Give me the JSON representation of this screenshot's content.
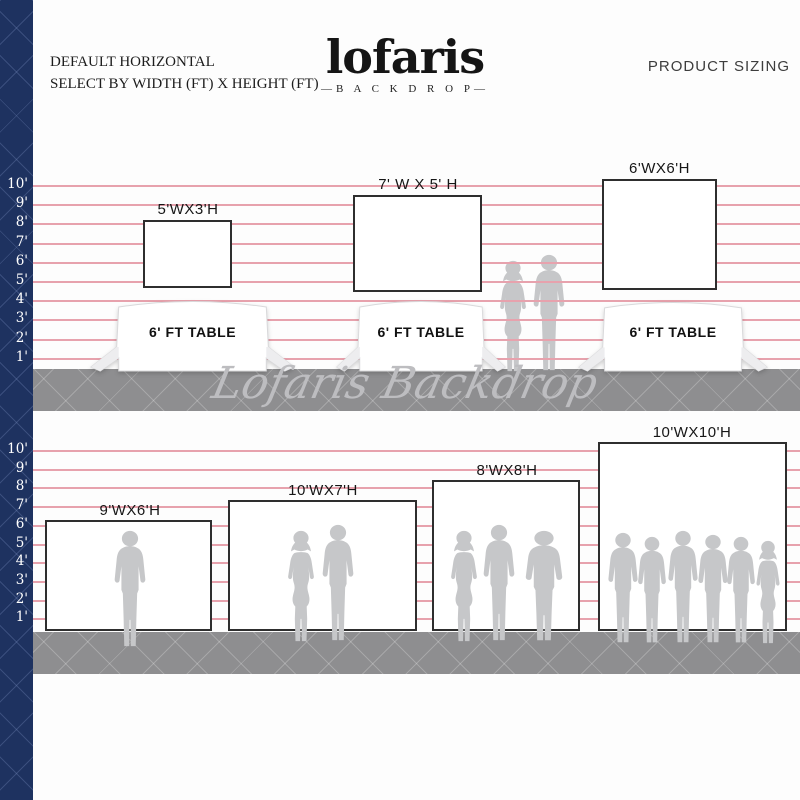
{
  "header": {
    "left_title_line1": "DEFAULT HORIZONTAL",
    "left_title_line2": "SELECT BY WIDTH (FT) X HEIGHT (FT)",
    "logo_name": "lofaris",
    "logo_sub": "—B A C K D R O P—",
    "right_title": "PRODUCT SIZING"
  },
  "watermark": "Lofaris Backdrop",
  "ruler": {
    "labels": [
      "10'",
      "9'",
      "8'",
      "7'",
      "6'",
      "5'",
      "4'",
      "3'",
      "2'",
      "1'"
    ],
    "unit": "ft"
  },
  "rows": [
    {
      "name": "table-backdrops",
      "items": [
        {
          "size_label": "5'WX3'H",
          "table_label": "6' FT TABLE"
        },
        {
          "size_label": "7' W X 5' H",
          "table_label": "6' FT TABLE"
        },
        {
          "size_label": "6'WX6'H",
          "table_label": "6' FT TABLE"
        }
      ]
    },
    {
      "name": "people-backdrops",
      "items": [
        {
          "size_label": "9'WX6'H",
          "people_count": 1
        },
        {
          "size_label": "10'WX7'H",
          "people_count": 2
        },
        {
          "size_label": "8'WX8'H",
          "people_count": 3
        },
        {
          "size_label": "10'WX10'H",
          "people_count": 6
        }
      ]
    }
  ],
  "colors": {
    "navy_strip": "#1e3260",
    "ruled_line_pink": "#e7a2ad",
    "floor_gray": "#8e8e90",
    "silhouette_gray": "#c6c7c9",
    "rect_border": "#2e2e2e",
    "watermark_gray": "#bdbdc0"
  }
}
